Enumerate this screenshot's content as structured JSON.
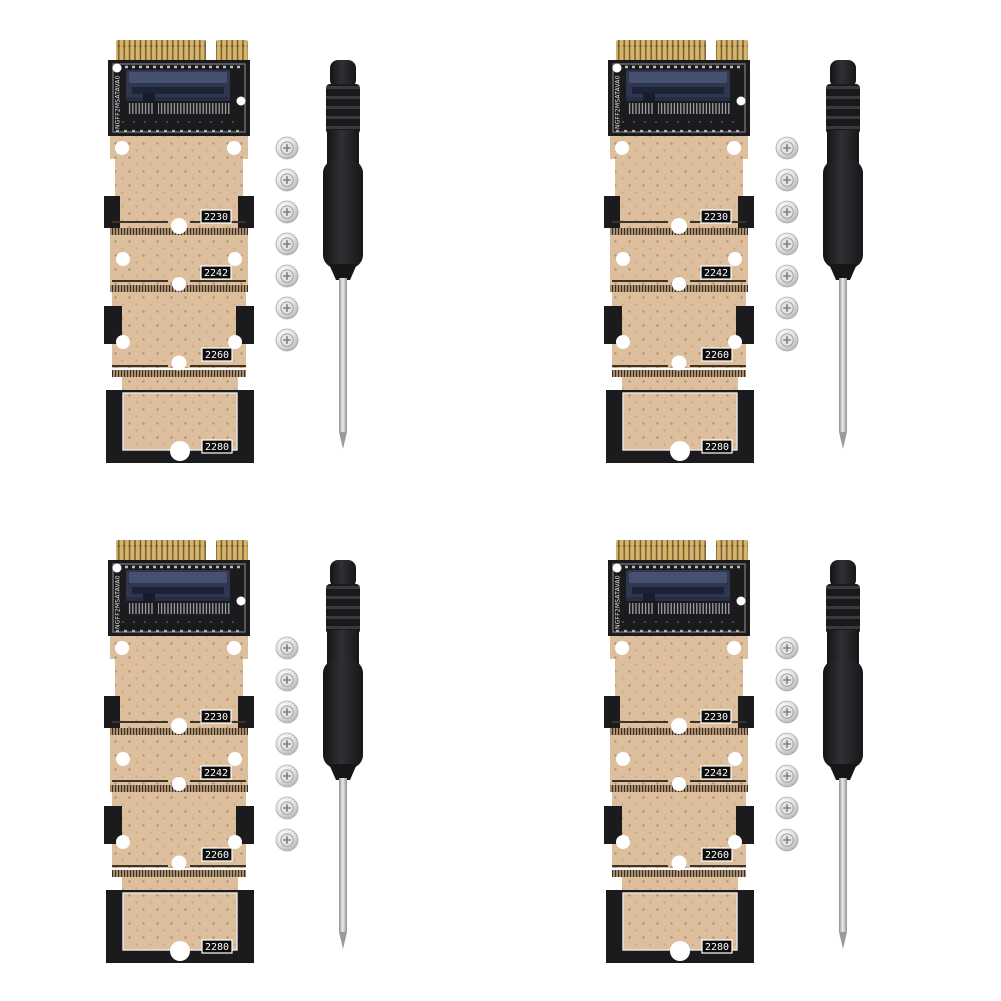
{
  "scene": {
    "type": "product-photo",
    "description": "Four identical M.2 NGFF to mSATA SSD adapter kits on a white background; each kit has one adapter PCB, seven silver mounting screws and one black mini screwdriver",
    "background_color": "#ffffff",
    "kit_count": 4
  },
  "adapter_card": {
    "model_label": "NGFF2MSATAVA0",
    "size_labels": [
      "2230",
      "2242",
      "2260",
      "2280"
    ],
    "colors": {
      "pcb_tan": "#ddbf9e",
      "pcb_black": "#1b1b1d",
      "gold_fingers": "#d6b46a",
      "socket_navy": "#2e3650",
      "label_box": "#0d0d0d",
      "label_text": "#ffffff"
    }
  },
  "screws": {
    "count": 7,
    "color": "#dedede"
  },
  "screwdriver": {
    "handle_color": "#1f1f1f",
    "shaft_color": "#c9c9cb"
  },
  "kits": [
    {
      "position": "top-left"
    },
    {
      "position": "top-right"
    },
    {
      "position": "bottom-left"
    },
    {
      "position": "bottom-right"
    }
  ]
}
